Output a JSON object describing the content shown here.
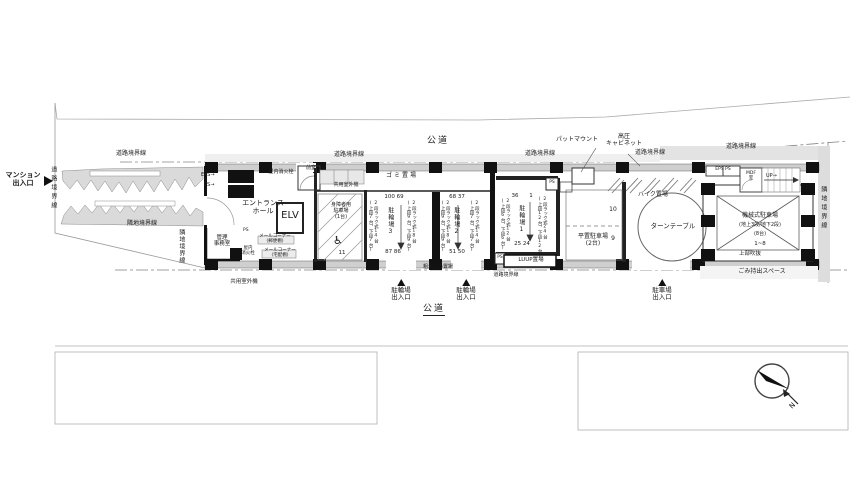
{
  "site": {
    "road_top": "公道",
    "road_bottom": "公道",
    "road_boundary": "道路境界線",
    "neighbor_boundary": "隣地境界線"
  },
  "entrances": {
    "mansion": {
      "l1": "マンション",
      "l2": "出入口",
      "arrow": "▶"
    },
    "bicycle": {
      "l1": "駐輪場",
      "l2": "出入口"
    },
    "car": {
      "l1": "駐車場",
      "l2": "出入口"
    }
  },
  "facilities": {
    "entrance_hall": {
      "l1": "エントランス",
      "l2": "ホール"
    },
    "elv": "ELV",
    "anteroom": "前室",
    "indoor_hydrant": "屋内消火栓",
    "indoor_hydrant_2": {
      "l1": "屋内",
      "l2": "消火栓"
    },
    "office": {
      "l1": "管理",
      "l2": "事務室"
    },
    "mail_corner_post": {
      "l1": "メールコーナー",
      "l2": "(郵便棚)"
    },
    "mail_corner_parcel": {
      "l1": "メールコーナー",
      "l2": "(宅配棚)"
    },
    "common_outdoor_unit": "共用室外機",
    "garbage": "ゴミ置場",
    "bulky_garbage": "粗大ごみ置場",
    "garbage_carryout": "ごみ持出スペース",
    "luup": "LUUP置場",
    "bike_area": "バイク置場",
    "turntable": "ターンテーブル",
    "pad_mount": "パットマウント",
    "hv_cabinet": {
      "l1": "高圧",
      "l2": "キャビネット"
    },
    "mdf": {
      "l1": "MDF",
      "l2": "室"
    },
    "up": "UP→",
    "eps_arrow": "EPS→",
    "ps_arrow": "PS→",
    "eps_ps": "EPS PS",
    "ps": "PS"
  },
  "parking": {
    "disabled": {
      "l1": "身障者用",
      "l2": "駐車場",
      "l3": "(1台)",
      "num": "11"
    },
    "flat": {
      "l1": "平置駐車場",
      "l2": "(2台)",
      "num_upper": "10",
      "num_lower": "9"
    },
    "machine": {
      "l1": "機械式駐車場",
      "l2": "(地上3段/地下2段)",
      "l3": "(8台)",
      "l4": "1~8",
      "l5": "上部吹抜"
    }
  },
  "bicycle_parking": {
    "area3": {
      "name": "駐輪場3",
      "nums_top": "100  69",
      "nums_bottom": "87  86",
      "rack_left": "2段ラック式14台",
      "rack_left_sub": "(上段7台、下段7台)",
      "rack_right": "2段ラック式18台",
      "rack_right_sub": "(上段9台、下段9台)"
    },
    "area2": {
      "name": "駐輪場2",
      "nums_top": "68  37",
      "nums_bottom": "51  50",
      "rack_left": "2段ラック式18台",
      "rack_left_sub": "(上段9台、下段9台)",
      "rack_right": "2段ラック式14台",
      "rack_right_sub": "(上段7台、下段7台)"
    },
    "area1": {
      "name": "駐輪場1",
      "num_tl": "36",
      "num_tr": "1",
      "nums_bottom": "25  24",
      "rack_left": "2段ラック式12台",
      "rack_left_sub": "(上段6台、下段6台)",
      "rack_right": "2段ラック式24台",
      "rack_right_sub": "(上段12台、下段12台)"
    }
  },
  "icons": {
    "wheelchair": "♿"
  },
  "compass": {
    "label": "N"
  }
}
